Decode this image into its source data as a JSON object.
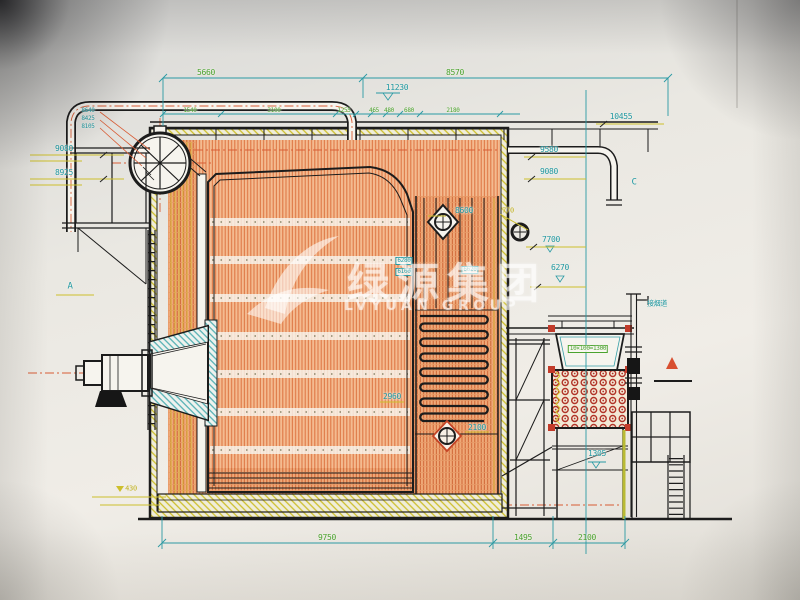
{
  "watermark": {
    "cn": "绿源集团",
    "en": "LVYUAN GROUP"
  },
  "colors": {
    "paper": "#eceae4",
    "dimension_cyan": "#1f98a2",
    "dimension_green": "#4aa32e",
    "dimension_yellow": "#c0b01c",
    "centerline_red": "#d85c35",
    "tube_wall_orange": "#e08550",
    "economizer_tube_red": "#b13428",
    "line_black": "#1c1c1c"
  },
  "annotations": [
    {
      "t": "5660",
      "x": 206,
      "y": 73,
      "c": "green"
    },
    {
      "t": "8570",
      "x": 455,
      "y": 73,
      "c": "green"
    },
    {
      "t": "11230",
      "x": 397,
      "y": 88,
      "c": "cyan"
    },
    {
      "t": "1540",
      "x": 190,
      "y": 111,
      "c": "green",
      "fs": 6
    },
    {
      "t": "3100",
      "x": 274,
      "y": 111,
      "c": "green",
      "fs": 6
    },
    {
      "t": "1255",
      "x": 344,
      "y": 111,
      "c": "green",
      "fs": 6
    },
    {
      "t": "465",
      "x": 374,
      "y": 111,
      "c": "green",
      "fs": 6
    },
    {
      "t": "480",
      "x": 389,
      "y": 111,
      "c": "green",
      "fs": 6
    },
    {
      "t": "680",
      "x": 409,
      "y": 111,
      "c": "green",
      "fs": 6
    },
    {
      "t": "2180",
      "x": 453,
      "y": 111,
      "c": "green",
      "fs": 6
    },
    {
      "t": "10455",
      "x": 621,
      "y": 117,
      "c": "cyan"
    },
    {
      "t": "9580",
      "x": 549,
      "y": 150,
      "c": "cyan"
    },
    {
      "t": "9080",
      "x": 549,
      "y": 172,
      "c": "cyan"
    },
    {
      "t": "C",
      "x": 634,
      "y": 183,
      "c": "cyan",
      "fs": 9,
      "n": "section-marker-c"
    },
    {
      "t": "9080",
      "x": 64,
      "y": 149,
      "c": "cyan"
    },
    {
      "t": "8925",
      "x": 64,
      "y": 173,
      "c": "cyan"
    },
    {
      "t": "8640",
      "x": 88,
      "y": 111,
      "c": "cyan",
      "fs": 6
    },
    {
      "t": "8425",
      "x": 88,
      "y": 119,
      "c": "cyan",
      "fs": 6
    },
    {
      "t": "8105",
      "x": 88,
      "y": 127,
      "c": "cyan",
      "fs": 6
    },
    {
      "t": "A",
      "x": 70,
      "y": 287,
      "c": "cyan",
      "fs": 9,
      "n": "section-marker-a"
    },
    {
      "t": "8600",
      "x": 464,
      "y": 211,
      "c": "cyan"
    },
    {
      "t": "770",
      "x": 508,
      "y": 211,
      "c": "yellow",
      "fs": 7
    },
    {
      "t": "7700",
      "x": 551,
      "y": 240,
      "c": "cyan"
    },
    {
      "t": "6270",
      "x": 560,
      "y": 268,
      "c": "cyan"
    },
    {
      "t": "6280",
      "x": 404,
      "y": 261,
      "c": "cyan",
      "fs": 6,
      "boxed": true
    },
    {
      "t": "6100",
      "x": 404,
      "y": 272,
      "c": "cyan",
      "fs": 6,
      "boxed": true
    },
    {
      "t": "6620",
      "x": 470,
      "y": 270,
      "c": "cyan",
      "fs": 6,
      "boxed": true
    },
    {
      "t": "2960",
      "x": 392,
      "y": 397,
      "c": "cyan"
    },
    {
      "t": "2100",
      "x": 477,
      "y": 428,
      "c": "cyan"
    },
    {
      "t": "10×100=1300",
      "x": 588,
      "y": 349,
      "c": "green",
      "fs": 6,
      "boxed": true,
      "n": "economizer-tube-pitch-label"
    },
    {
      "t": "接烟道",
      "x": 657,
      "y": 304,
      "c": "cyan",
      "fs": 7,
      "n": "pipe-connection-label"
    },
    {
      "t": "1305",
      "x": 597,
      "y": 454,
      "c": "cyan"
    },
    {
      "t": "430",
      "x": 131,
      "y": 489,
      "c": "yellow",
      "fs": 7
    },
    {
      "t": "9750",
      "x": 327,
      "y": 538,
      "c": "green"
    },
    {
      "t": "1495",
      "x": 523,
      "y": 538,
      "c": "green"
    },
    {
      "t": "2100",
      "x": 587,
      "y": 538,
      "c": "green"
    }
  ]
}
